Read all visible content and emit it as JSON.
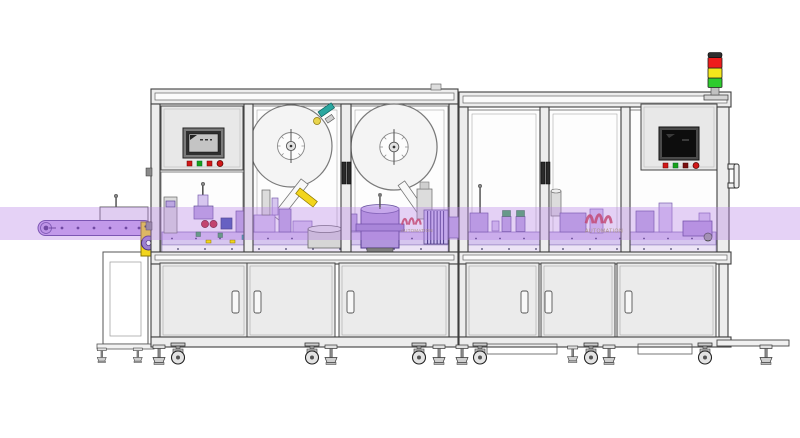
{
  "branding": {
    "watermark": "AUTOMATION"
  },
  "colors": {
    "band": "#b783e6",
    "conveyor_belt": "#c9a6ec",
    "conveyor_edge": "#5c3d96",
    "machinery_light": "#d6c6ef",
    "machinery_mid": "#bca6e2",
    "turntable": "#b195dd",
    "accent_yellow": "#f2d51c",
    "accent_teal": "#2aa7a0",
    "accent_red": "#c8202c",
    "accent_blue": "#3a4fae",
    "accent_green": "#3aa655",
    "signal_red": "#ee1c1c",
    "signal_yellow": "#f4e71c",
    "signal_green": "#2ecc2e",
    "button_red": "#d01818",
    "button_green": "#18a018",
    "button_dark": "#7a1010",
    "frame_stroke": "#3f3f3f",
    "panel_fill": "#e8e8e8",
    "door_fill": "#ebebeb",
    "glass_fill": "#fdfdfd",
    "watermark_text": "#a39a45"
  },
  "signal_tower": {
    "segments": [
      "red",
      "yellow",
      "green"
    ]
  },
  "left_hmi": {
    "indicator_buttons": [
      "red",
      "green",
      "red",
      "red"
    ]
  },
  "right_hmi": {
    "indicator_buttons": [
      "red",
      "green",
      "dark-red",
      "red"
    ]
  }
}
